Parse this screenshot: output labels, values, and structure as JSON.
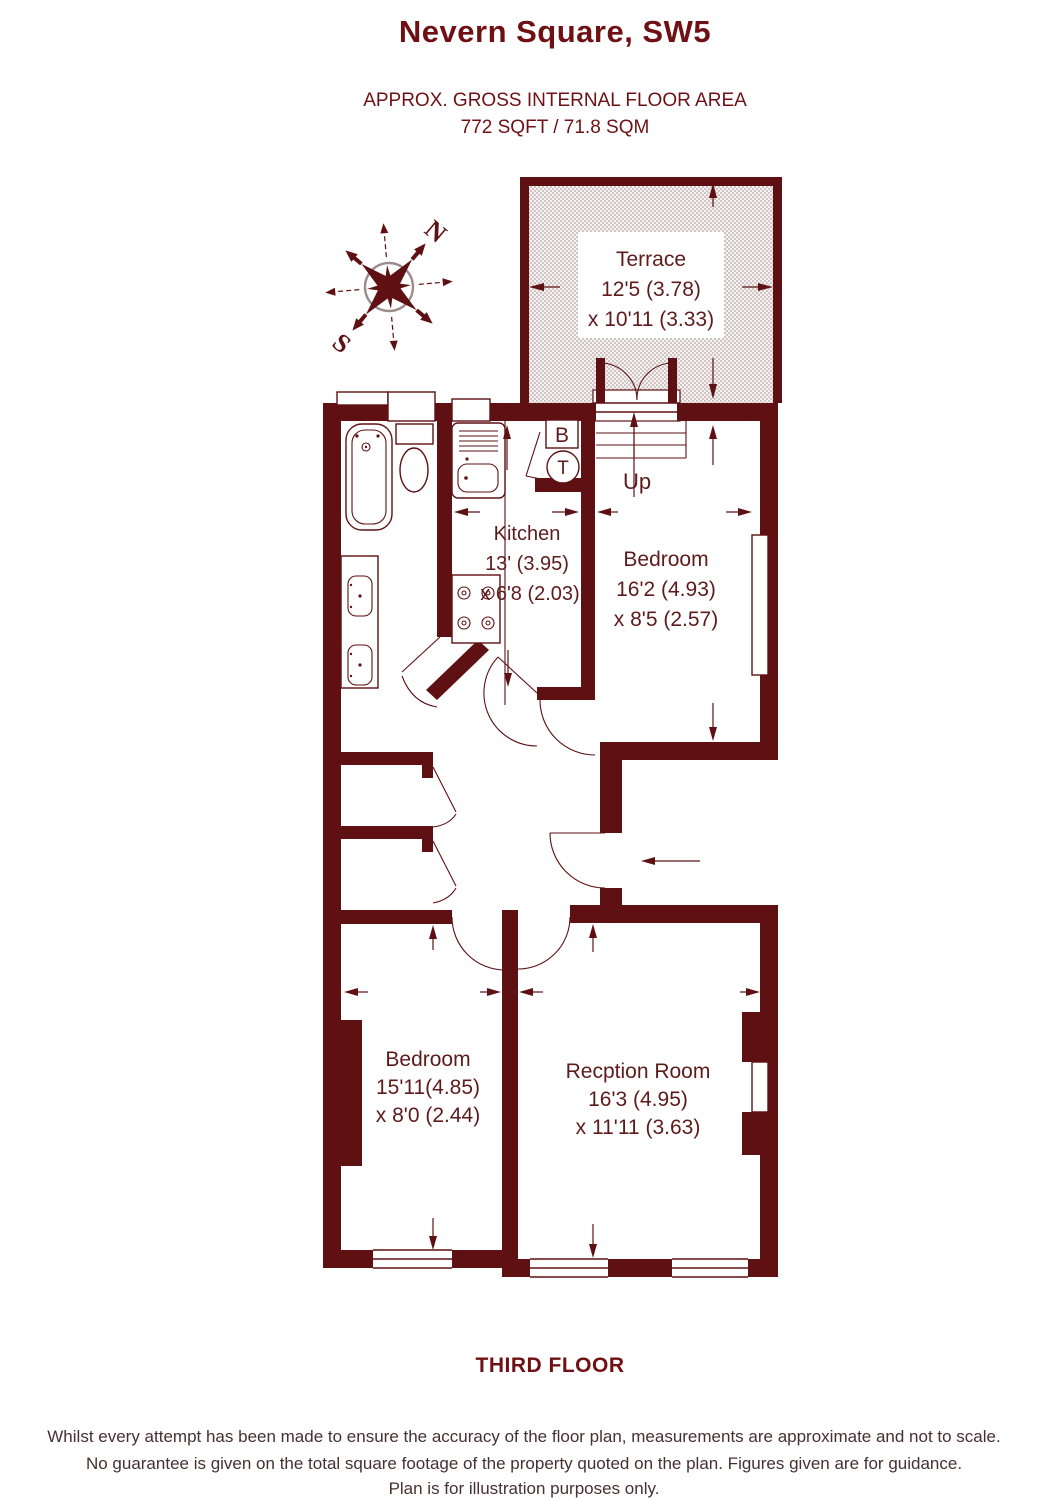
{
  "header": {
    "title": "Nevern Square, SW5",
    "area_line1": "APPROX. GROSS INTERNAL FLOOR AREA",
    "area_line2": "772 SQFT / 71.8 SQM"
  },
  "plan": {
    "rooms": {
      "terrace": {
        "name": "Terrace",
        "dim_line1": "12'5 (3.78)",
        "dim_line2": "x 10'11 (3.33)"
      },
      "kitchen": {
        "name": "Kitchen",
        "dim_line1": "13' (3.95)",
        "dim_line2": "x 6'8 (2.03)"
      },
      "bedroom_top": {
        "name": "Bedroom",
        "dim_line1": "16'2 (4.93)",
        "dim_line2": "x 8'5 (2.57)"
      },
      "bedroom_bottom": {
        "name": "Bedroom",
        "dim_line1": "15'11(4.85)",
        "dim_line2": "x 8'0 (2.44)"
      },
      "reception": {
        "name": "Recption Room",
        "dim_line1": "16'3 (4.95)",
        "dim_line2": "x 11'11 (3.63)"
      }
    },
    "stairs_label": "Up",
    "boiler_label": "B",
    "tank_label": "T",
    "compass": {
      "north": "N",
      "south": "S"
    }
  },
  "footer": {
    "floor_label": "THIRD FLOOR",
    "disclaimer_line1": "Whilst every attempt has been made to ensure the accuracy of the floor plan, measurements are approximate and not to scale.",
    "disclaimer_line2": "No guarantee is given on the total square footage of the property quoted on the plan. Figures given are for guidance.",
    "disclaimer_line3": "Plan is for illustration purposes only."
  },
  "colors": {
    "wall": "#5e1012",
    "title": "#6f1114",
    "room_text": "#5e1b1b",
    "disclaimer": "#463032",
    "compass_circle": "#9b8b8b"
  }
}
